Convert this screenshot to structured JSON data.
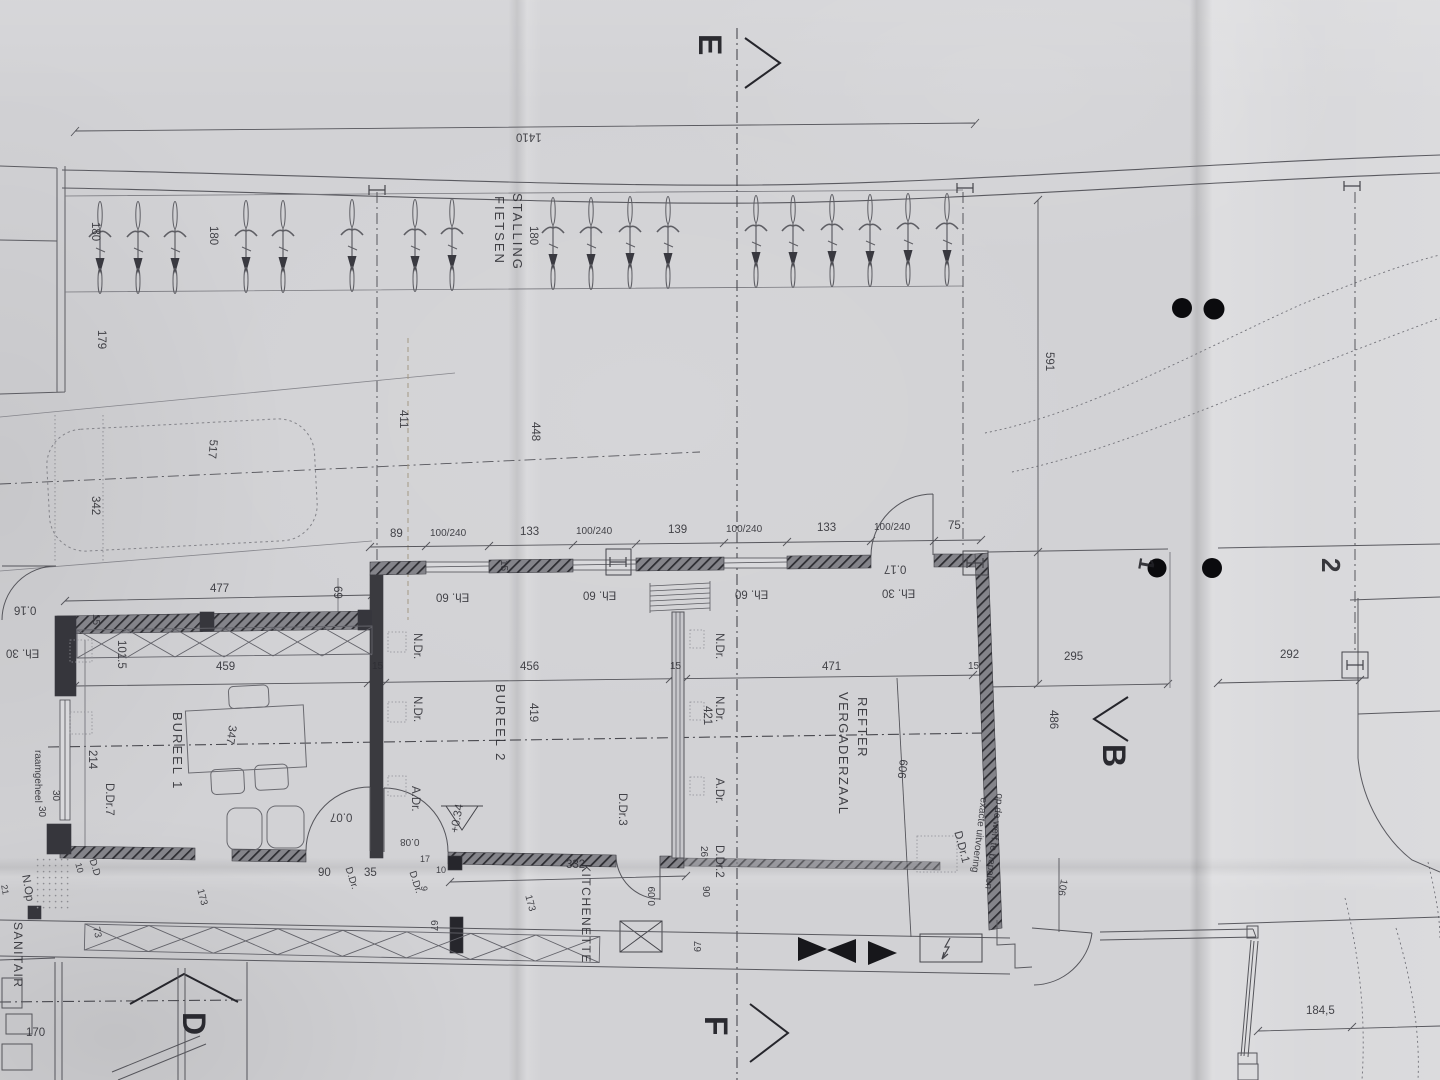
{
  "section_markers": {
    "e": "E",
    "f": "F",
    "b": "B",
    "d": "D"
  },
  "grid_markers": {
    "g1": "1",
    "g2": "2"
  },
  "rooms": {
    "fietsen": "FIETSEN",
    "stalling": "STALLING",
    "bureel1": "BUREEL 1",
    "bureel2": "BUREEL 2",
    "vergaderzaal": "VERGADERZAAL",
    "refter": "REFTER",
    "kitchenette": "KITCHENETTE",
    "sanitair": "SANITAIR"
  },
  "notes": {
    "raamgeheel": "raamgeheel",
    "exacte_line1": "exacte uitvoering",
    "exacte_line2": "op de werf te bepalen",
    "n_op": "N.Op",
    "level_plus": "+0.34"
  },
  "door_labels": {
    "ndr": "N.Dr.",
    "adr": "A.Dr.",
    "ddr1": "D.Dr.1",
    "ddr2": "D.Dr.2",
    "ddr3": "D.Dr.3",
    "ddr7": "D.Dr.7",
    "ddr": "D.Dr.",
    "dd": "D.D"
  },
  "window_labels": {
    "eh60": "Eh. 60",
    "eh30": "Eh. 30"
  },
  "floor_levels": {
    "v016": "0.16",
    "v017": "0.17",
    "v007": "0.07",
    "v008": "0.08",
    "v009": "0.09"
  },
  "dim_row_top": [
    "89",
    "100/240",
    "133",
    "100/240",
    "139",
    "100/240",
    "133",
    "100/240",
    "75"
  ],
  "dims": {
    "d1410": "1410",
    "d180": "180",
    "d179": "179",
    "d517": "517",
    "d342": "342",
    "d411": "411",
    "d448": "448",
    "d591": "591",
    "d477": "477",
    "d69": "69",
    "d459": "459",
    "d456": "456",
    "d471": "471",
    "d295": "295",
    "d292": "292",
    "d486": "486",
    "d606": "606",
    "d419": "419",
    "d421": "421",
    "d347": "347",
    "d101_5": "101.5",
    "d214": "214",
    "d15": "15",
    "d10": "10",
    "d30": "30",
    "d90": "90",
    "d35": "35",
    "d17": "17",
    "d9": "9",
    "d67": "67",
    "d26": "26",
    "d73": "73",
    "d173": "173",
    "d170": "170",
    "d106": "106",
    "d184_5": "184,5",
    "d332": "332",
    "d21": "21"
  }
}
